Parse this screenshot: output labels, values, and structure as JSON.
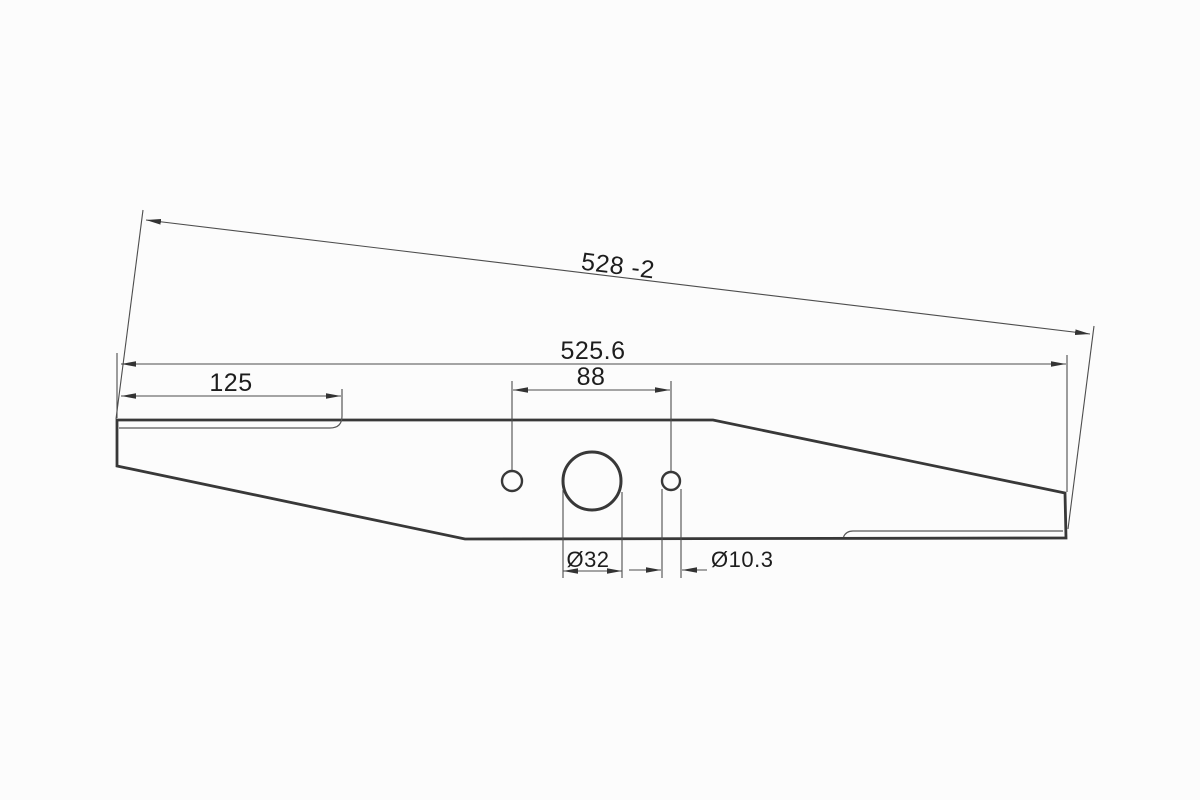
{
  "drawing": {
    "colors": {
      "background": "#fcfcfc",
      "outline": "#383838",
      "dimension_lines": "#4d4d4d",
      "text": "#1d1d1d"
    },
    "labels": {
      "overall_length_with_tolerance": "528 -2",
      "overall_length": "525.6",
      "cutting_edge_length": "125",
      "hole_center_spacing": "88",
      "center_hole_diameter": "Ø32",
      "side_hole_diameter": "Ø10.3"
    }
  }
}
